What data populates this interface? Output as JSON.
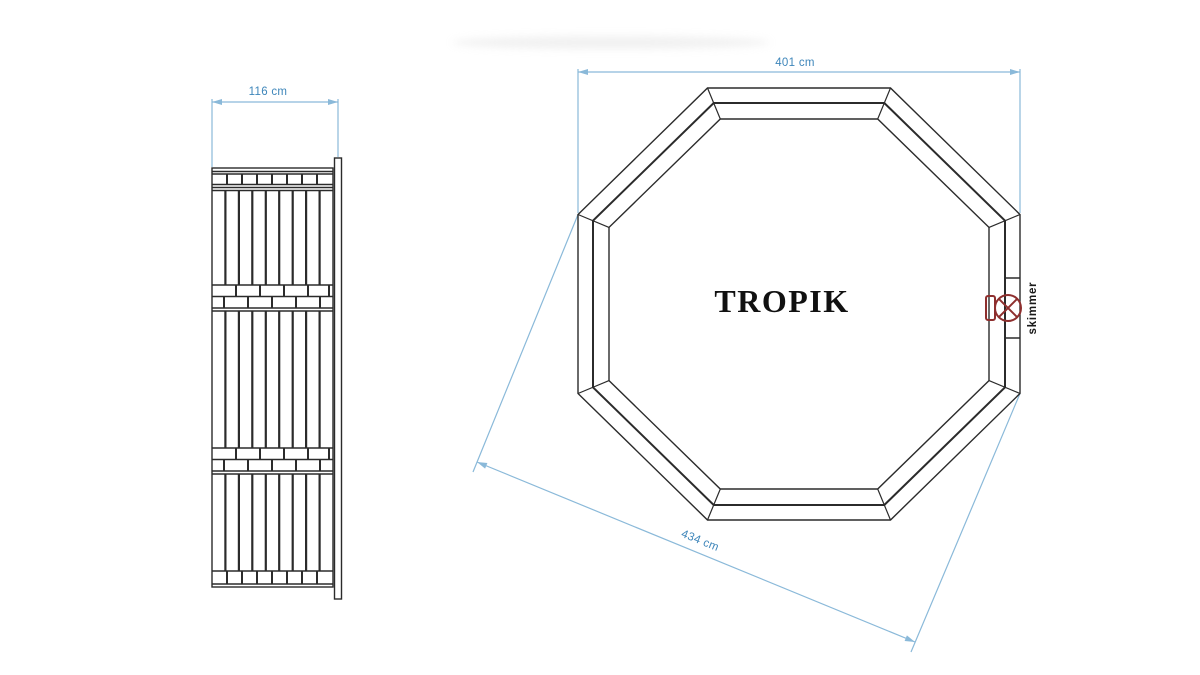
{
  "drawing": {
    "model_name": "TROPIK",
    "side_view": {
      "width_label": "116 cm"
    },
    "top_view": {
      "width_label": "401 cm",
      "diagonal_label": "434 cm",
      "skimmer_label": "skimmer"
    }
  },
  "colors": {
    "dimension_line_blue": "#8ab9d9",
    "dimension_text_blue": "#3e86ba",
    "drawing_line_dark": "#2b2b2b",
    "skimmer_red": "#8e2f2e",
    "model_text_black": "#111111",
    "background": "#ffffff"
  }
}
